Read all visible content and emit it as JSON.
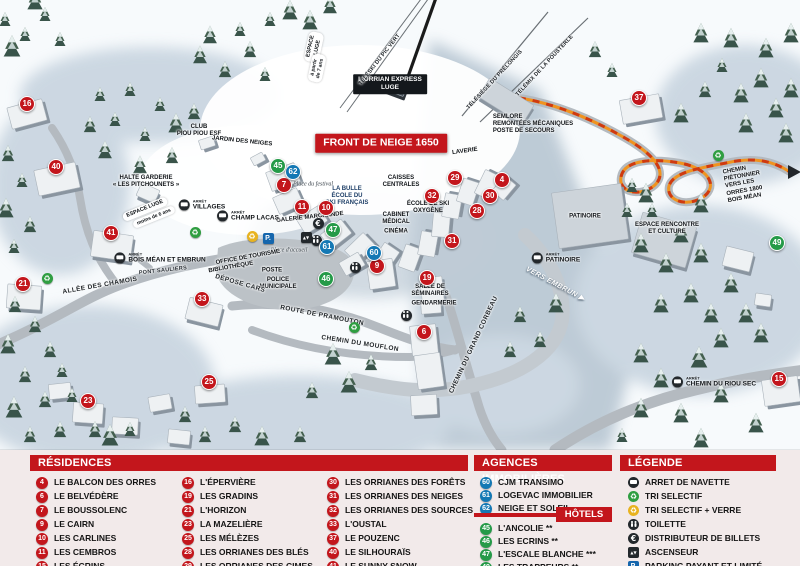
{
  "colors": {
    "marker_red": "#c3161c",
    "marker_blue": "#1478b4",
    "marker_green": "#259a48",
    "path_orange": "#f0931f",
    "panel_pink": "#f2eaea"
  },
  "map": {
    "banner": "FRONT DE NEIGE 1650",
    "arret_label": "ARRÊT",
    "markers": [
      {
        "n": "16",
        "type": "residence",
        "x": 27,
        "y": 104
      },
      {
        "n": "40",
        "type": "residence",
        "x": 56,
        "y": 167
      },
      {
        "n": "41",
        "type": "residence",
        "x": 111,
        "y": 233
      },
      {
        "n": "21",
        "type": "residence",
        "x": 23,
        "y": 284
      },
      {
        "n": "33",
        "type": "residence",
        "x": 202,
        "y": 299
      },
      {
        "n": "23",
        "type": "residence",
        "x": 88,
        "y": 401
      },
      {
        "n": "25",
        "type": "residence",
        "x": 209,
        "y": 382
      },
      {
        "n": "7",
        "type": "residence",
        "x": 284,
        "y": 185
      },
      {
        "n": "11",
        "type": "residence",
        "x": 302,
        "y": 207
      },
      {
        "n": "10",
        "type": "residence",
        "x": 326,
        "y": 208
      },
      {
        "n": "9",
        "type": "residence",
        "x": 377,
        "y": 266
      },
      {
        "n": "19",
        "type": "residence",
        "x": 427,
        "y": 278
      },
      {
        "n": "6",
        "type": "residence",
        "x": 424,
        "y": 332
      },
      {
        "n": "32",
        "type": "residence",
        "x": 432,
        "y": 196
      },
      {
        "n": "29",
        "type": "residence",
        "x": 455,
        "y": 178
      },
      {
        "n": "28",
        "type": "residence",
        "x": 477,
        "y": 211
      },
      {
        "n": "31",
        "type": "residence",
        "x": 452,
        "y": 241
      },
      {
        "n": "30",
        "type": "residence",
        "x": 490,
        "y": 196
      },
      {
        "n": "4",
        "type": "residence",
        "x": 502,
        "y": 180
      },
      {
        "n": "37",
        "type": "residence",
        "x": 639,
        "y": 98
      },
      {
        "n": "15",
        "type": "residence",
        "x": 779,
        "y": 379
      },
      {
        "n": "60",
        "type": "agence",
        "x": 374,
        "y": 253
      },
      {
        "n": "61",
        "type": "agence",
        "x": 327,
        "y": 247
      },
      {
        "n": "62",
        "type": "agence",
        "x": 293,
        "y": 172
      },
      {
        "n": "45",
        "type": "hotel",
        "x": 278,
        "y": 166
      },
      {
        "n": "46",
        "type": "hotel",
        "x": 326,
        "y": 279
      },
      {
        "n": "47",
        "type": "hotel",
        "x": 333,
        "y": 230
      },
      {
        "n": "49",
        "type": "hotel",
        "x": 777,
        "y": 243
      }
    ],
    "labels": [
      {
        "text": "FRONT DE NEIGE 1650",
        "x": 381,
        "y": 143,
        "rot": 0,
        "cls": "banner",
        "name": "front-de-neige-banner"
      },
      {
        "text": "L'ORRIAN EXPRESS\nLUGE",
        "x": 390,
        "y": 84,
        "rot": 0,
        "cls": "blackbox",
        "name": "orrian-express-label"
      },
      {
        "text": "ESPACE\nLUGE",
        "x": 314,
        "y": 47,
        "rot": -78,
        "cls": "pill"
      },
      {
        "text": "à partir\nde 7 ans",
        "x": 317,
        "y": 68,
        "rot": -78,
        "cls": "pill pillsmall"
      },
      {
        "text": "TÉLÉSKI DU PIC VERT",
        "x": 380,
        "y": 60,
        "rot": -52,
        "cls": "lift",
        "name": "lift-label"
      },
      {
        "text": "TÉLÉSIÈGE DU PRÉLONGIS",
        "x": 495,
        "y": 80,
        "rot": -47,
        "cls": "lift",
        "name": "lift-label"
      },
      {
        "text": "TÉLÉMIX DE LA POUSTERLE",
        "x": 545,
        "y": 66,
        "rot": -47,
        "cls": "lift",
        "name": "lift-label"
      },
      {
        "text": "SEMLORE\nREMONTÉES MÉCANIQUES\nPOSTE DE SECOURS",
        "x": 533,
        "y": 125,
        "rot": 0,
        "cls": "sm left"
      },
      {
        "text": "LAVERIE",
        "x": 465,
        "y": 152,
        "rot": -8,
        "cls": "sm"
      },
      {
        "text": "CAISSES\nCENTRALES",
        "x": 401,
        "y": 182,
        "rot": 0,
        "cls": "sm"
      },
      {
        "text": "LA BULLE\nÉCOLE DU\nSKI FRANÇAIS",
        "x": 347,
        "y": 197,
        "rot": 0,
        "cls": "sm navy"
      },
      {
        "text": "ÉCOLE DE SKI\nOXYGÈNE",
        "x": 428,
        "y": 208,
        "rot": 0,
        "cls": "sm"
      },
      {
        "text": "CABINET\nMÉDICAL",
        "x": 396,
        "y": 219,
        "rot": 0,
        "cls": "sm"
      },
      {
        "text": "CINÉMA",
        "x": 396,
        "y": 232,
        "rot": 0,
        "cls": "sm"
      },
      {
        "text": "GALERIE MARCHANDE",
        "x": 310,
        "y": 218,
        "rot": -6,
        "cls": "sm"
      },
      {
        "text": "Place du festival",
        "x": 313,
        "y": 185,
        "rot": 0,
        "cls": "ital"
      },
      {
        "text": "Place d'accueil",
        "x": 289,
        "y": 251,
        "rot": 0,
        "cls": "ital"
      },
      {
        "text": "OFFICE DE TOURISME",
        "x": 248,
        "y": 258,
        "rot": -10,
        "cls": "sm"
      },
      {
        "text": "BIBLIOTHÈQUE",
        "x": 231,
        "y": 268,
        "rot": -10,
        "cls": "sm"
      },
      {
        "text": "POSTE",
        "x": 272,
        "y": 271,
        "rot": 0,
        "cls": "sm"
      },
      {
        "text": "POLICE\nMUNICIPALE",
        "x": 278,
        "y": 284,
        "rot": 0,
        "cls": "sm"
      },
      {
        "text": "DÉPOSE CARS",
        "x": 240,
        "y": 284,
        "rot": 16,
        "cls": "road"
      },
      {
        "text": "SALLE DE\nSÉMINAIRES",
        "x": 430,
        "y": 291,
        "rot": 0,
        "cls": "sm"
      },
      {
        "text": "GENDARMERIE",
        "x": 434,
        "y": 304,
        "rot": 0,
        "cls": "sm"
      },
      {
        "text": "ALLÉE DES CHAMOIS",
        "x": 100,
        "y": 286,
        "rot": -10,
        "cls": "road"
      },
      {
        "text": "PONT SAULIERS",
        "x": 163,
        "y": 271,
        "rot": -6,
        "cls": "roadsm"
      },
      {
        "text": "ROUTE DE PRAMOUTON",
        "x": 322,
        "y": 316,
        "rot": 11,
        "cls": "road"
      },
      {
        "text": "CHEMIN DU MOUFLON",
        "x": 360,
        "y": 344,
        "rot": 9,
        "cls": "road"
      },
      {
        "text": "CHEMIN DU GRAND CORBEAU",
        "x": 474,
        "y": 345,
        "rot": -65,
        "cls": "road"
      },
      {
        "text": "VERS EMBRUN ▶",
        "x": 555,
        "y": 285,
        "rot": 28,
        "cls": "vers"
      },
      {
        "text": "CHEMIN PIÉTONNIER\nVERS LES ORRES 1800\nBOIS MÉAN",
        "x": 750,
        "y": 183,
        "rot": -10,
        "cls": "sm left"
      },
      {
        "text": "PATINOIRE",
        "x": 585,
        "y": 217,
        "rot": 0,
        "cls": "sm"
      },
      {
        "text": "ESPACE RENCONTRE\nET CULTURE",
        "x": 667,
        "y": 229,
        "rot": 0,
        "cls": "sm"
      },
      {
        "text": "HALTE GARDERIE\n« LES PITCHOUNETS »",
        "x": 146,
        "y": 182,
        "rot": 0,
        "cls": "sm"
      },
      {
        "text": "CLUB\nPIOU PIOU ESF",
        "x": 199,
        "y": 131,
        "rot": 0,
        "cls": "sm"
      },
      {
        "text": "JARDIN DES NEIGES",
        "x": 242,
        "y": 142,
        "rot": 6,
        "cls": "sm"
      },
      {
        "text": "ESPACE LUGE",
        "x": 145,
        "y": 209,
        "rot": -22,
        "cls": "pill"
      },
      {
        "text": "moins de 6 ans",
        "x": 154,
        "y": 217,
        "rot": -22,
        "cls": "pill pillsmall"
      }
    ],
    "bus_stops": [
      {
        "label": "VILLAGES",
        "x": 202,
        "y": 205
      },
      {
        "label": "CHAMP LACAS",
        "x": 248,
        "y": 216
      },
      {
        "label": "BOIS MÉAN ET EMBRUN",
        "x": 160,
        "y": 258
      },
      {
        "label": "PATINOIRE",
        "x": 556,
        "y": 258
      },
      {
        "label": "CHEMIN DU RIOU SEC",
        "x": 714,
        "y": 382
      }
    ],
    "icons": [
      {
        "type": "parking",
        "x": 268,
        "y": 238
      },
      {
        "type": "recycle-yellow",
        "x": 252,
        "y": 236
      },
      {
        "type": "recycle-green",
        "x": 195,
        "y": 232
      },
      {
        "type": "recycle-green",
        "x": 47,
        "y": 278
      },
      {
        "type": "recycle-green",
        "x": 354,
        "y": 327
      },
      {
        "type": "recycle-green",
        "x": 718,
        "y": 155
      },
      {
        "type": "euro",
        "x": 318,
        "y": 223
      },
      {
        "type": "elevator",
        "x": 306,
        "y": 237
      },
      {
        "type": "wc",
        "x": 316,
        "y": 240
      },
      {
        "type": "wc",
        "x": 355,
        "y": 267
      },
      {
        "type": "wc",
        "x": 406,
        "y": 315
      }
    ]
  },
  "legend": {
    "residences": {
      "title": "RÉSIDENCES",
      "columns": [
        [
          {
            "n": "4",
            "label": "LE BALCON DES ORRES"
          },
          {
            "n": "6",
            "label": "LE BELVÉDÈRE"
          },
          {
            "n": "7",
            "label": "LE BOUSSOLENC"
          },
          {
            "n": "9",
            "label": "LE CAIRN"
          },
          {
            "n": "10",
            "label": "LES CARLINES"
          },
          {
            "n": "11",
            "label": "LES CEMBROS"
          },
          {
            "n": "15",
            "label": "LES ÉCRINS"
          }
        ],
        [
          {
            "n": "16",
            "label": "L'ÉPERVIÈRE"
          },
          {
            "n": "19",
            "label": "LES GRADINS"
          },
          {
            "n": "21",
            "label": "L'HORIZON"
          },
          {
            "n": "23",
            "label": "LA MAZELIÈRE"
          },
          {
            "n": "25",
            "label": "LES MÉLÈZES"
          },
          {
            "n": "28",
            "label": "LES ORRIANES DES BLÉS"
          },
          {
            "n": "29",
            "label": "LES ORRIANES DES CIMES"
          }
        ],
        [
          {
            "n": "30",
            "label": "LES ORRIANES DES FORÊTS"
          },
          {
            "n": "31",
            "label": "LES ORRIANES DES NEIGES"
          },
          {
            "n": "32",
            "label": "LES ORRIANES DES SOURCES"
          },
          {
            "n": "33",
            "label": "L'OUSTAL"
          },
          {
            "n": "37",
            "label": "LE POUZENC"
          },
          {
            "n": "40",
            "label": "LE SILHOURAÏS"
          },
          {
            "n": "41",
            "label": "LE SUNNY SNOW"
          }
        ]
      ]
    },
    "agences": {
      "title": "AGENCES IMMOBILIÈRES",
      "items": [
        {
          "n": "60",
          "label": "CJM TRANSIMO"
        },
        {
          "n": "61",
          "label": "LOGEVAC IMMOBILIER"
        },
        {
          "n": "62",
          "label": "NEIGE ET SOLEIL"
        }
      ]
    },
    "hotels": {
      "title": "HÔTELS",
      "items": [
        {
          "n": "45",
          "label": "L'ANCOLIE **"
        },
        {
          "n": "46",
          "label": "LES ECRINS **"
        },
        {
          "n": "47",
          "label": "L'ESCALE BLANCHE ***"
        },
        {
          "n": "49",
          "label": "LES TRAPPEURS **"
        }
      ]
    },
    "legende": {
      "title": "LÉGENDE",
      "items": [
        {
          "icon": "bus",
          "label": "ARRET DE NAVETTE"
        },
        {
          "icon": "recycle-green",
          "label": "TRI SELECTIF"
        },
        {
          "icon": "recycle-yellow",
          "label": "TRI SELECTIF + VERRE"
        },
        {
          "icon": "wc",
          "label": "TOILETTE"
        },
        {
          "icon": "euro",
          "label": "DISTRIBUTEUR DE BILLETS"
        },
        {
          "icon": "elevator",
          "label": "ASCENSEUR"
        },
        {
          "icon": "parking",
          "label": "PARKING PAYANT ET LIMITÉ"
        }
      ]
    }
  }
}
